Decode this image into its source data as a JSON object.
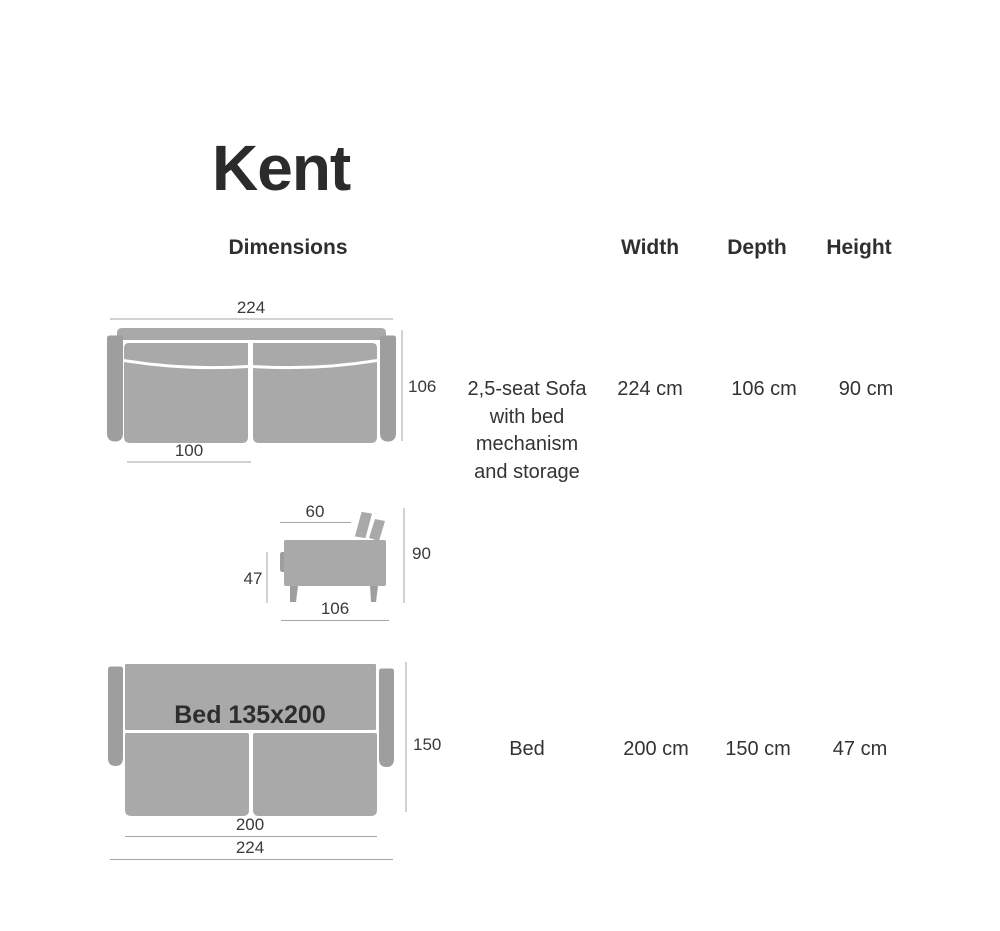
{
  "page": {
    "title": "Kent"
  },
  "table": {
    "headers": {
      "dimensions": "Dimensions",
      "width": "Width",
      "depth": "Depth",
      "height": "Height"
    },
    "rows": [
      {
        "name_lines": [
          "2,5-seat Sofa",
          "with bed",
          "mechanism",
          "and storage"
        ],
        "width": "224 cm",
        "depth": "106 cm",
        "height": "90 cm"
      },
      {
        "name_lines": [
          "Bed"
        ],
        "width": "200 cm",
        "depth": "150 cm",
        "height": "47 cm"
      }
    ]
  },
  "diagrams": {
    "top_view": {
      "labels": {
        "width": "224",
        "depth": "106",
        "seat_width": "100"
      }
    },
    "side_view": {
      "labels": {
        "back_depth": "60",
        "height": "90",
        "seat_height": "47",
        "depth": "106"
      }
    },
    "bed_view": {
      "labels": {
        "bed_size": "Bed 135x200",
        "open_depth": "150",
        "bed_length": "200",
        "width": "224"
      }
    }
  },
  "colors": {
    "sofa_body": "#a9a9a9",
    "armrest": "#9e9e9e",
    "dim_line": "#a6a6a6",
    "label_text": "#3a3a3a",
    "title_text": "#2b2b2b"
  }
}
